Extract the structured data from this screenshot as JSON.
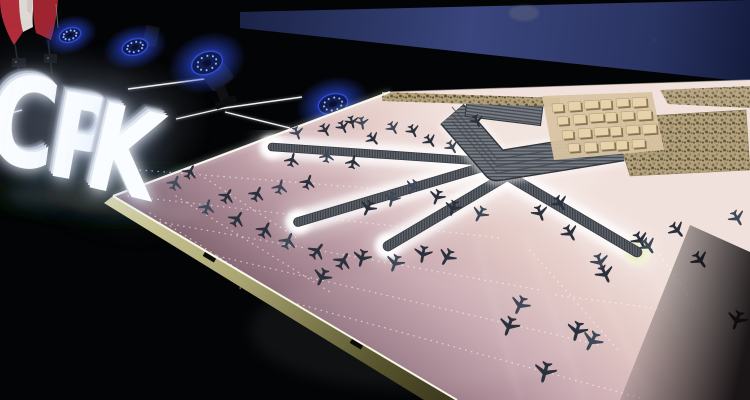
{
  "meta": {
    "description": "Photograph: illuminated CPK letters on a dark stage beside a large pink architectural scale model of the planned CPK airport, with Polish flags and blue stage lights"
  },
  "colors": {
    "bg": "#030405",
    "screen_navy_1": "#39457c",
    "screen_navy_2": "#141c3e",
    "flag_white": "#ded8d3",
    "flag_white_2": "#cfc8c2",
    "flag_red": "#b02c38",
    "flag_red_2": "#9e2530",
    "sign_face": "#fafdff",
    "stage_light_blue": "#2d4ce0",
    "stage_light_ring": "#9fbcff",
    "led_strip_white": "#f8fbff",
    "model_light": "#f1e1dc",
    "model_dark": "#573f4a",
    "edge_light": "#d6d1a0",
    "edge_dark": "#3e3b20",
    "pier_gray": "#5d626a",
    "pier_dark": "#383c43",
    "apron_white": "#ffffff",
    "apron_warm": "#edf0c8",
    "plane_dark": "#2a303c",
    "plane_light": "#3e4857",
    "tree_base": "#b49e7c",
    "building_tan": "#e6d2ab",
    "building_shadow": "#71603f"
  },
  "sign": {
    "text": "CPK",
    "letters": [
      {
        "char": "C",
        "x": -2,
        "y": 58,
        "size": 124,
        "rot": 8
      },
      {
        "char": "P",
        "x": 62,
        "y": 76,
        "size": 118,
        "rot": 10
      },
      {
        "char": "K",
        "x": 104,
        "y": 88,
        "size": 120,
        "rot": 13
      }
    ]
  },
  "stage_lights": [
    {
      "x": 70,
      "y": 35,
      "rx": 11,
      "ry": 7,
      "rot": -18,
      "fixture": false
    },
    {
      "x": 135,
      "y": 47,
      "rx": 13,
      "ry": 8,
      "rot": -15,
      "fixture": false
    },
    {
      "x": 207,
      "y": 63,
      "rx": 16,
      "ry": 11,
      "rot": -22,
      "fixture": true
    },
    {
      "x": 333,
      "y": 104,
      "rx": 15,
      "ry": 10,
      "rot": -15,
      "fixture": false
    }
  ],
  "led_lines": [
    [
      128,
      89,
      204,
      79
    ],
    [
      176,
      119,
      224,
      108
    ],
    [
      224,
      108,
      302,
      97
    ],
    [
      225,
      112,
      290,
      128
    ],
    [
      0,
      116,
      22,
      110
    ]
  ],
  "piers": [
    {
      "x1": 272,
      "y1": 147,
      "x2": 479,
      "y2": 161,
      "w": 7,
      "end_glow": "start"
    },
    {
      "x1": 483,
      "y1": 167,
      "x2": 298,
      "y2": 222,
      "w": 8,
      "end_glow": "end"
    },
    {
      "x1": 503,
      "y1": 178,
      "x2": 388,
      "y2": 246,
      "w": 9,
      "end_glow": "end"
    },
    {
      "x1": 505,
      "y1": 174,
      "x2": 637,
      "y2": 252,
      "w": 9,
      "end_glow": "end_warm"
    },
    {
      "x1": 618,
      "y1": 146,
      "x2": 668,
      "y2": 154,
      "w": 6,
      "end_glow": "none"
    }
  ],
  "terminal": {
    "points": "452,114 497,166 622,146",
    "width": 28
  },
  "station_roof": {
    "x": 466,
    "y": 101,
    "w": 76,
    "h": 20,
    "rot": 7
  },
  "dotted_lines": [
    [
      150,
      213,
      435,
      395
    ],
    [
      176,
      196,
      330,
      292
    ],
    [
      140,
      170,
      468,
      196
    ],
    [
      128,
      196,
      500,
      238
    ],
    [
      160,
      222,
      540,
      290
    ],
    [
      200,
      252,
      600,
      345
    ],
    [
      240,
      288,
      640,
      398
    ],
    [
      660,
      255,
      706,
      322
    ],
    [
      556,
      295,
      668,
      310
    ],
    [
      530,
      250,
      620,
      352
    ],
    [
      205,
      178,
      300,
      240
    ]
  ],
  "sheen_lines": [
    [
      475,
      235,
      520,
      400
    ],
    [
      525,
      235,
      585,
      400
    ],
    [
      575,
      228,
      650,
      400
    ],
    [
      625,
      220,
      715,
      400
    ]
  ],
  "planes": [
    [
      297,
      133,
      160
    ],
    [
      325,
      130,
      150
    ],
    [
      352,
      122,
      165
    ],
    [
      362,
      123,
      170
    ],
    [
      343,
      127,
      155
    ],
    [
      373,
      139,
      140
    ],
    [
      393,
      128,
      150
    ],
    [
      413,
      131,
      155
    ],
    [
      430,
      141,
      145
    ],
    [
      452,
      147,
      150
    ],
    [
      477,
      121,
      160
    ],
    [
      292,
      160,
      15
    ],
    [
      327,
      156,
      10
    ],
    [
      353,
      162,
      12
    ],
    [
      190,
      172,
      28
    ],
    [
      175,
      183,
      22
    ],
    [
      257,
      194,
      25
    ],
    [
      227,
      196,
      30
    ],
    [
      207,
      207,
      18
    ],
    [
      237,
      219,
      33
    ],
    [
      265,
      230,
      28
    ],
    [
      288,
      241,
      24
    ],
    [
      317,
      251,
      38
    ],
    [
      343,
      261,
      30
    ],
    [
      280,
      187,
      15
    ],
    [
      308,
      182,
      20
    ],
    [
      368,
      208,
      205
    ],
    [
      392,
      199,
      195
    ],
    [
      322,
      277,
      205
    ],
    [
      362,
      258,
      195
    ],
    [
      395,
      263,
      200
    ],
    [
      423,
      254,
      190
    ],
    [
      447,
      257,
      210
    ],
    [
      413,
      187,
      205
    ],
    [
      437,
      197,
      200
    ],
    [
      453,
      208,
      196
    ],
    [
      480,
      214,
      208
    ],
    [
      540,
      213,
      160
    ],
    [
      560,
      203,
      150
    ],
    [
      520,
      305,
      205
    ],
    [
      509,
      326,
      200
    ],
    [
      577,
      331,
      195
    ],
    [
      592,
      341,
      208
    ],
    [
      545,
      372,
      195
    ],
    [
      570,
      233,
      150
    ],
    [
      600,
      262,
      160
    ],
    [
      605,
      274,
      155
    ],
    [
      640,
      240,
      150
    ],
    [
      648,
      246,
      145
    ],
    [
      677,
      230,
      140
    ],
    [
      700,
      260,
      145
    ],
    [
      737,
      218,
      150
    ],
    [
      737,
      320,
      200
    ]
  ],
  "buildings": [
    [
      552,
      104
    ],
    [
      568,
      102
    ],
    [
      584,
      101
    ],
    [
      600,
      100
    ],
    [
      616,
      99
    ],
    [
      632,
      98
    ],
    [
      557,
      117
    ],
    [
      573,
      115
    ],
    [
      589,
      114
    ],
    [
      605,
      113
    ],
    [
      621,
      112
    ],
    [
      637,
      111
    ],
    [
      562,
      131
    ],
    [
      578,
      129
    ],
    [
      594,
      128
    ],
    [
      610,
      127
    ],
    [
      626,
      126
    ],
    [
      642,
      125
    ],
    [
      568,
      144
    ],
    [
      584,
      143
    ],
    [
      600,
      142
    ],
    [
      616,
      141
    ],
    [
      632,
      140
    ]
  ],
  "edge_gaps": [
    [
      205,
      252,
      31
    ],
    [
      352,
      339,
      31
    ]
  ]
}
